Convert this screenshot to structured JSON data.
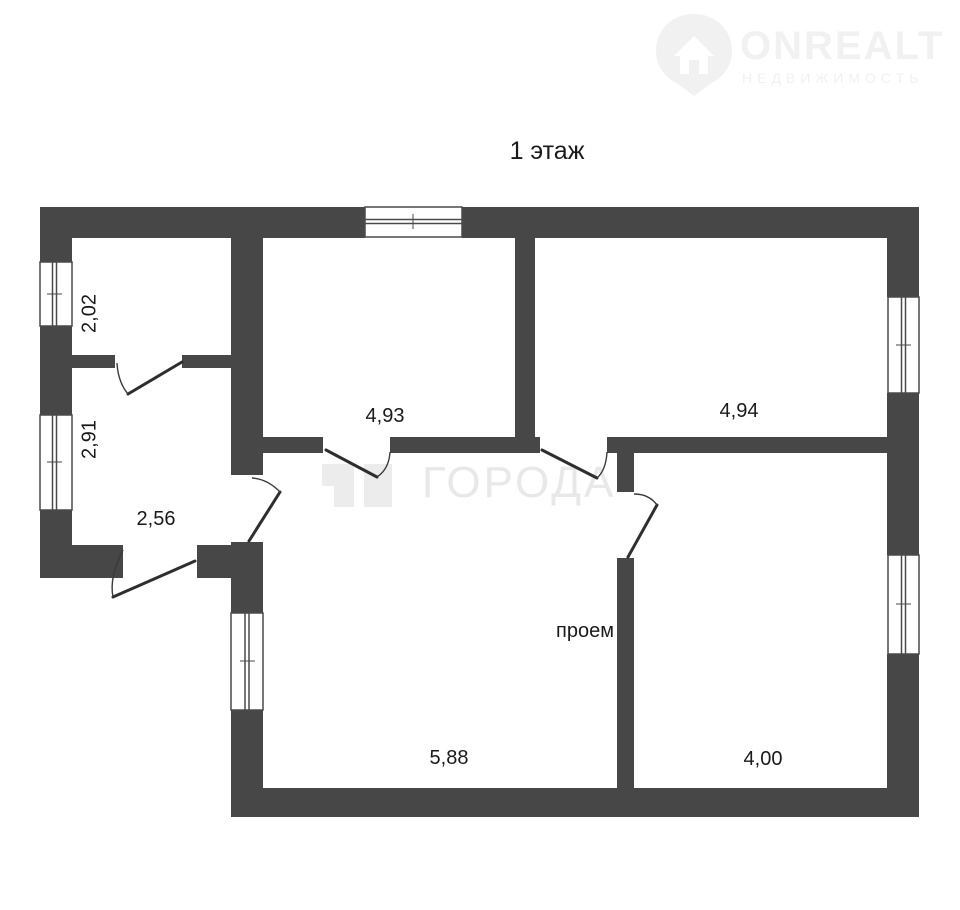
{
  "page": {
    "title": "1 этаж"
  },
  "brand": {
    "name": "ONREALT",
    "tagline": "НЕДВИЖИМОСТЬ"
  },
  "watermark": {
    "text": "ГОРОДА"
  },
  "dimensions": {
    "room_top_left": "2,02",
    "hall_upper": "2,91",
    "hall_lower": "2,56",
    "room_mid_top": "4,93",
    "room_top_right": "4,94",
    "room_bottom_mid": "5,88",
    "room_bottom_right": "4,00"
  },
  "annotations": {
    "opening": "проем"
  },
  "colors": {
    "wall": "#474747",
    "label_text": "#1a1a1a",
    "watermark_text": "#e8e8e8",
    "brand_watermark": "#f1f1f1",
    "background": "#ffffff"
  }
}
